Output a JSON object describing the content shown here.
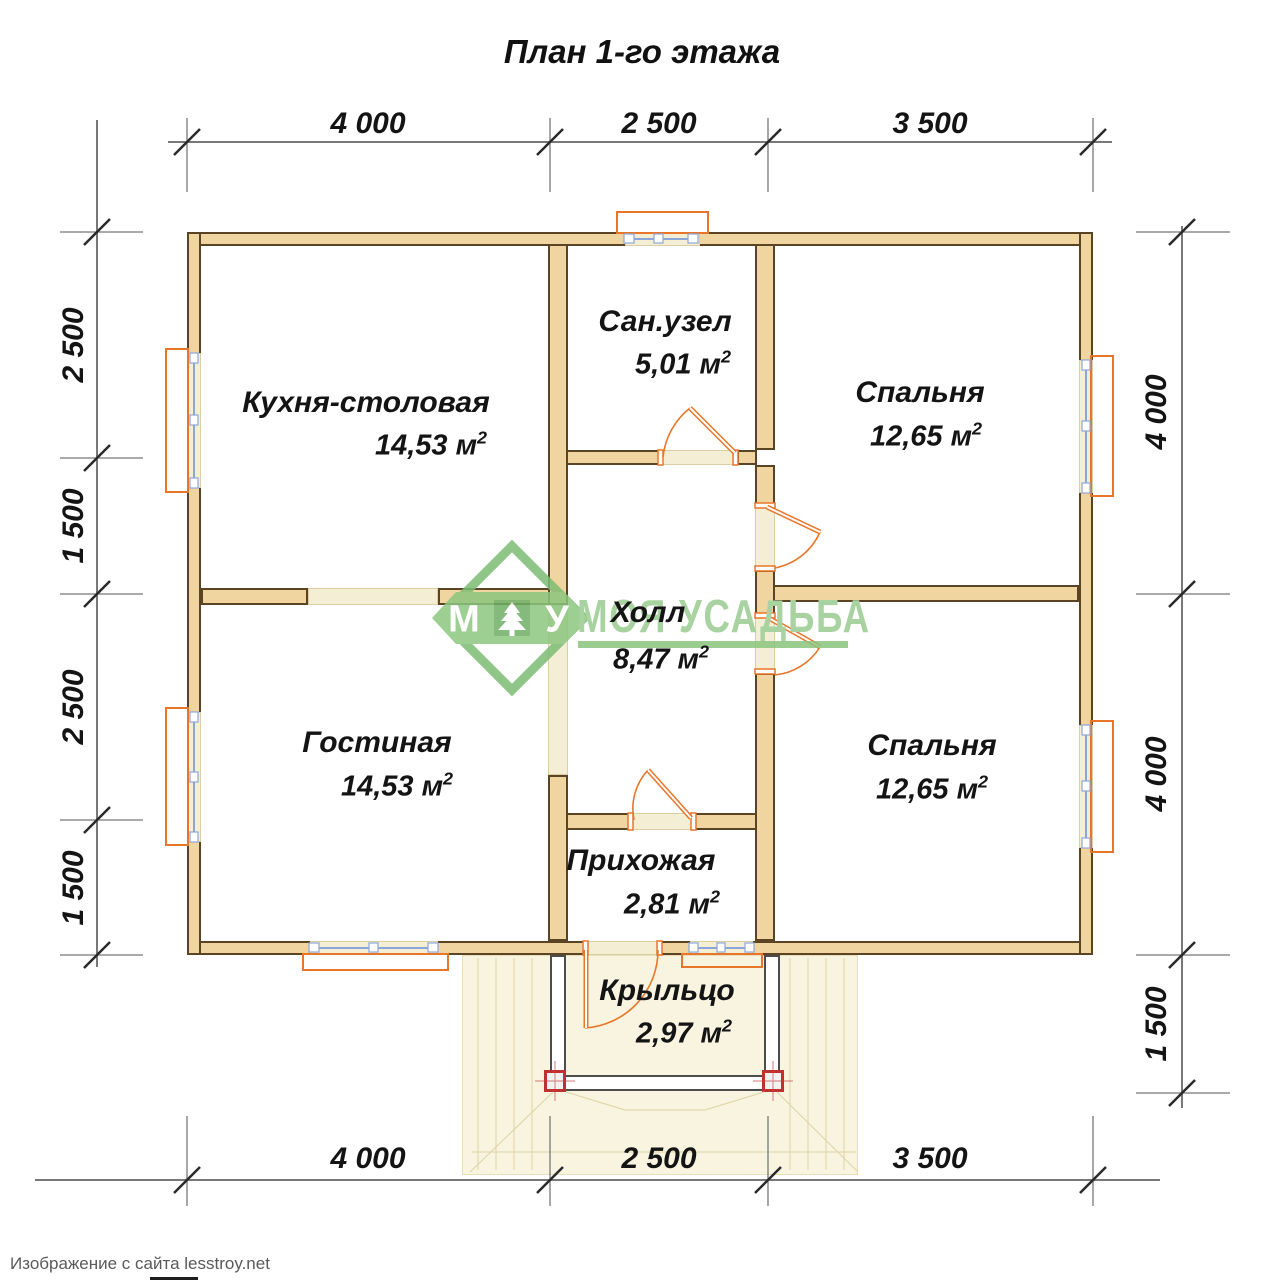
{
  "title": "План 1-го этажа",
  "rooms": [
    {
      "name": "Кухня-столовая",
      "area": "14,53 м"
    },
    {
      "name": "Сан.узел",
      "area": "5,01 м"
    },
    {
      "name": "Спальня",
      "area": "12,65 м"
    },
    {
      "name": "Гостиная",
      "area": "14,53 м"
    },
    {
      "name": "Холл",
      "area": "8,47 м"
    },
    {
      "name": "Спальня",
      "area": "12,65 м"
    },
    {
      "name": "Прихожая",
      "area": "2,81 м"
    },
    {
      "name": "Крыльцо",
      "area": "2,97 м"
    }
  ],
  "sup2": "2",
  "dimensions": {
    "top": [
      "4 000",
      "2 500",
      "3 500"
    ],
    "bottom": [
      "4 000",
      "2 500",
      "3 500"
    ],
    "left": [
      "2 500",
      "1 500",
      "2 500",
      "1 500"
    ],
    "right": [
      "4 000",
      "4 000",
      "1 500"
    ]
  },
  "watermark": {
    "letter_left": "М",
    "letter_right": "У",
    "brand": "МОЯ УСАДЬБА"
  },
  "attribution": "Изображение с сайта lesstroy.net",
  "colors": {
    "wall_fill": "#f0d5a0",
    "wall_outline": "#5a4423",
    "threshold": "#f4eed5",
    "accent_orange": "#e8762a",
    "window_blue": "#8ba7d9",
    "watermark_green": "#8ac47e",
    "post_red": "#c03030",
    "dimension_gray": "#787878"
  }
}
